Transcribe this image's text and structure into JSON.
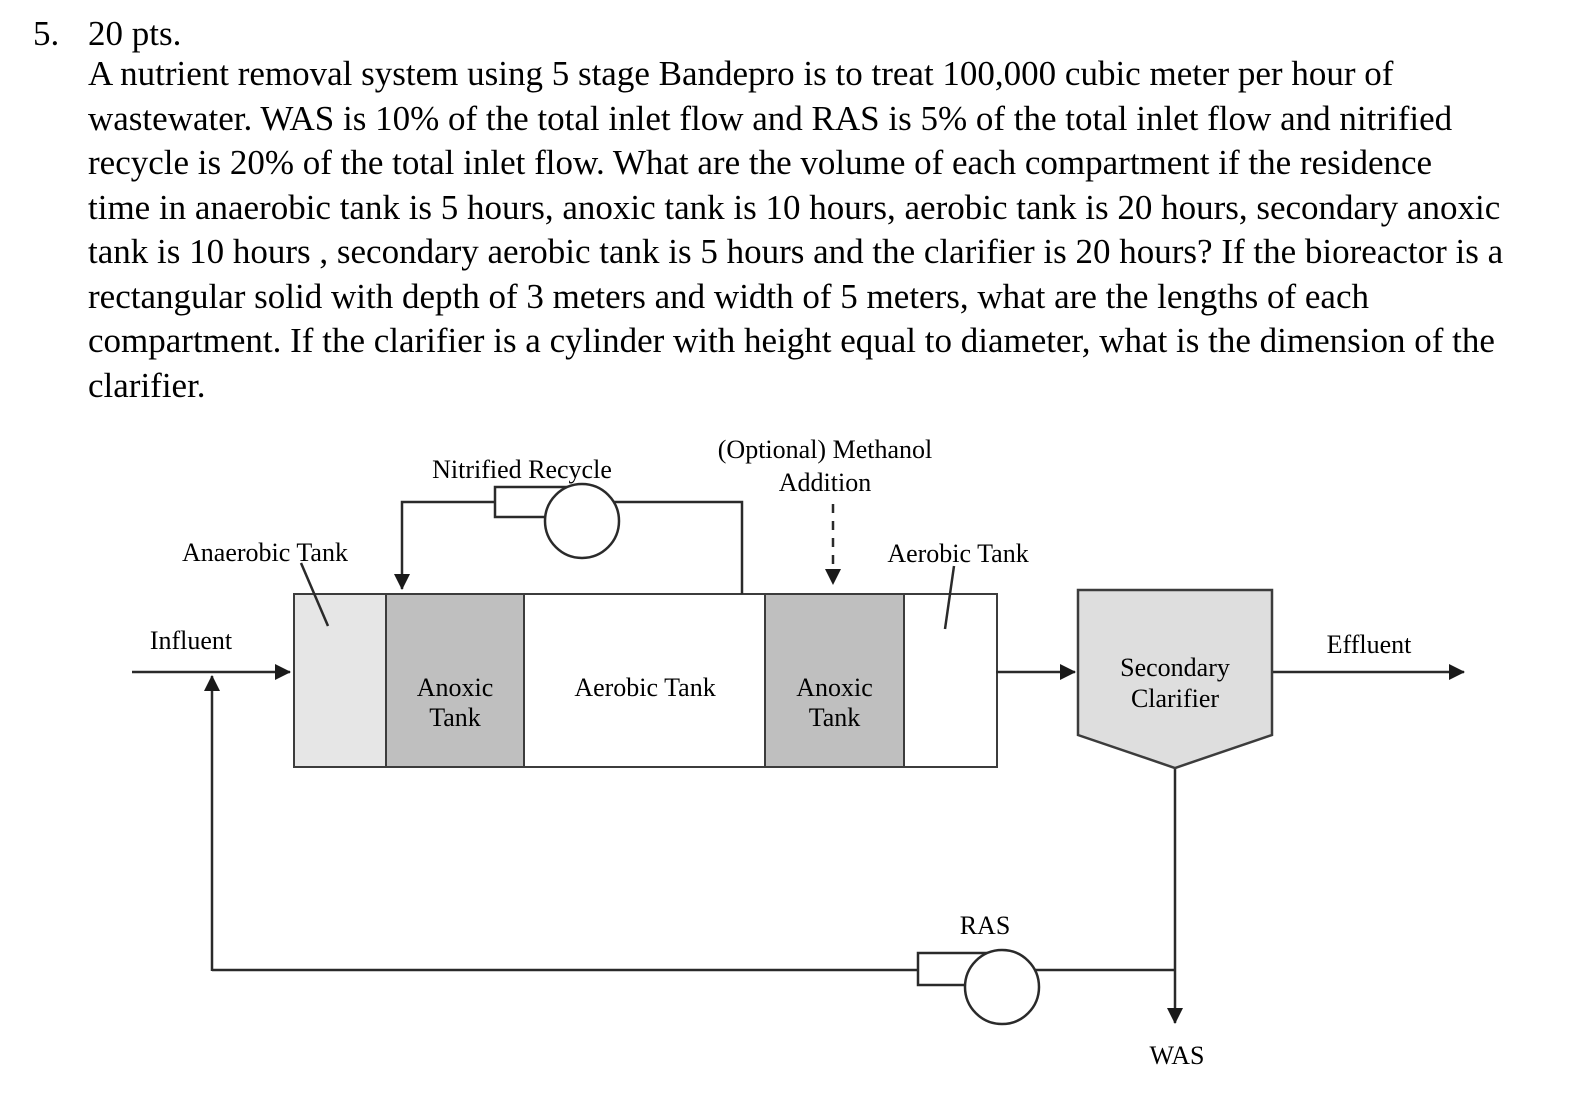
{
  "problem": {
    "number": "5.",
    "points": "20 pts.",
    "lines": [
      "A nutrient removal system using 5 stage Bandepro is to treat 100,000 cubic meter per hour of",
      "wastewater. WAS is 10% of the total inlet flow and RAS is 5% of the total inlet flow and nitrified",
      "recycle is 20% of the total inlet flow. What are the volume of each compartment if the residence",
      "time in anaerobic tank is 5 hours, anoxic tank is 10 hours, aerobic tank is 20 hours, secondary anoxic",
      "tank is 10 hours , secondary aerobic tank is 5 hours and the clarifier is 20 hours? If the bioreactor is a",
      "rectangular solid with depth of 3 meters and width of 5 meters, what are the lengths of each",
      "compartment. If the clarifier is a cylinder with height equal to diameter, what is the dimension of the",
      "clarifier."
    ]
  },
  "diagram": {
    "influent_label": "Influent",
    "effluent_label": "Effluent",
    "nitrified_recycle_label": "Nitrified Recycle",
    "methanol_label": "(Optional) Methanol\nAddition",
    "anaerobic_tank_label": "Anaerobic Tank",
    "aerobic_tank_callout_label": "Aerobic Tank",
    "ras_label": "RAS",
    "was_label": "WAS",
    "tanks": {
      "anoxic1": "Anoxic\nTank",
      "aerobic": "Aerobic Tank",
      "anoxic2": "Anoxic\nTank"
    },
    "clarifier_label": "Secondary\nClarifier",
    "colors": {
      "anaerobic_fill": "#e6e6e6",
      "anoxic_fill": "#bfbfbf",
      "aerobic_fill": "#ffffff",
      "clarifier_fill": "#dedede",
      "line": "#2a2a2a"
    }
  }
}
